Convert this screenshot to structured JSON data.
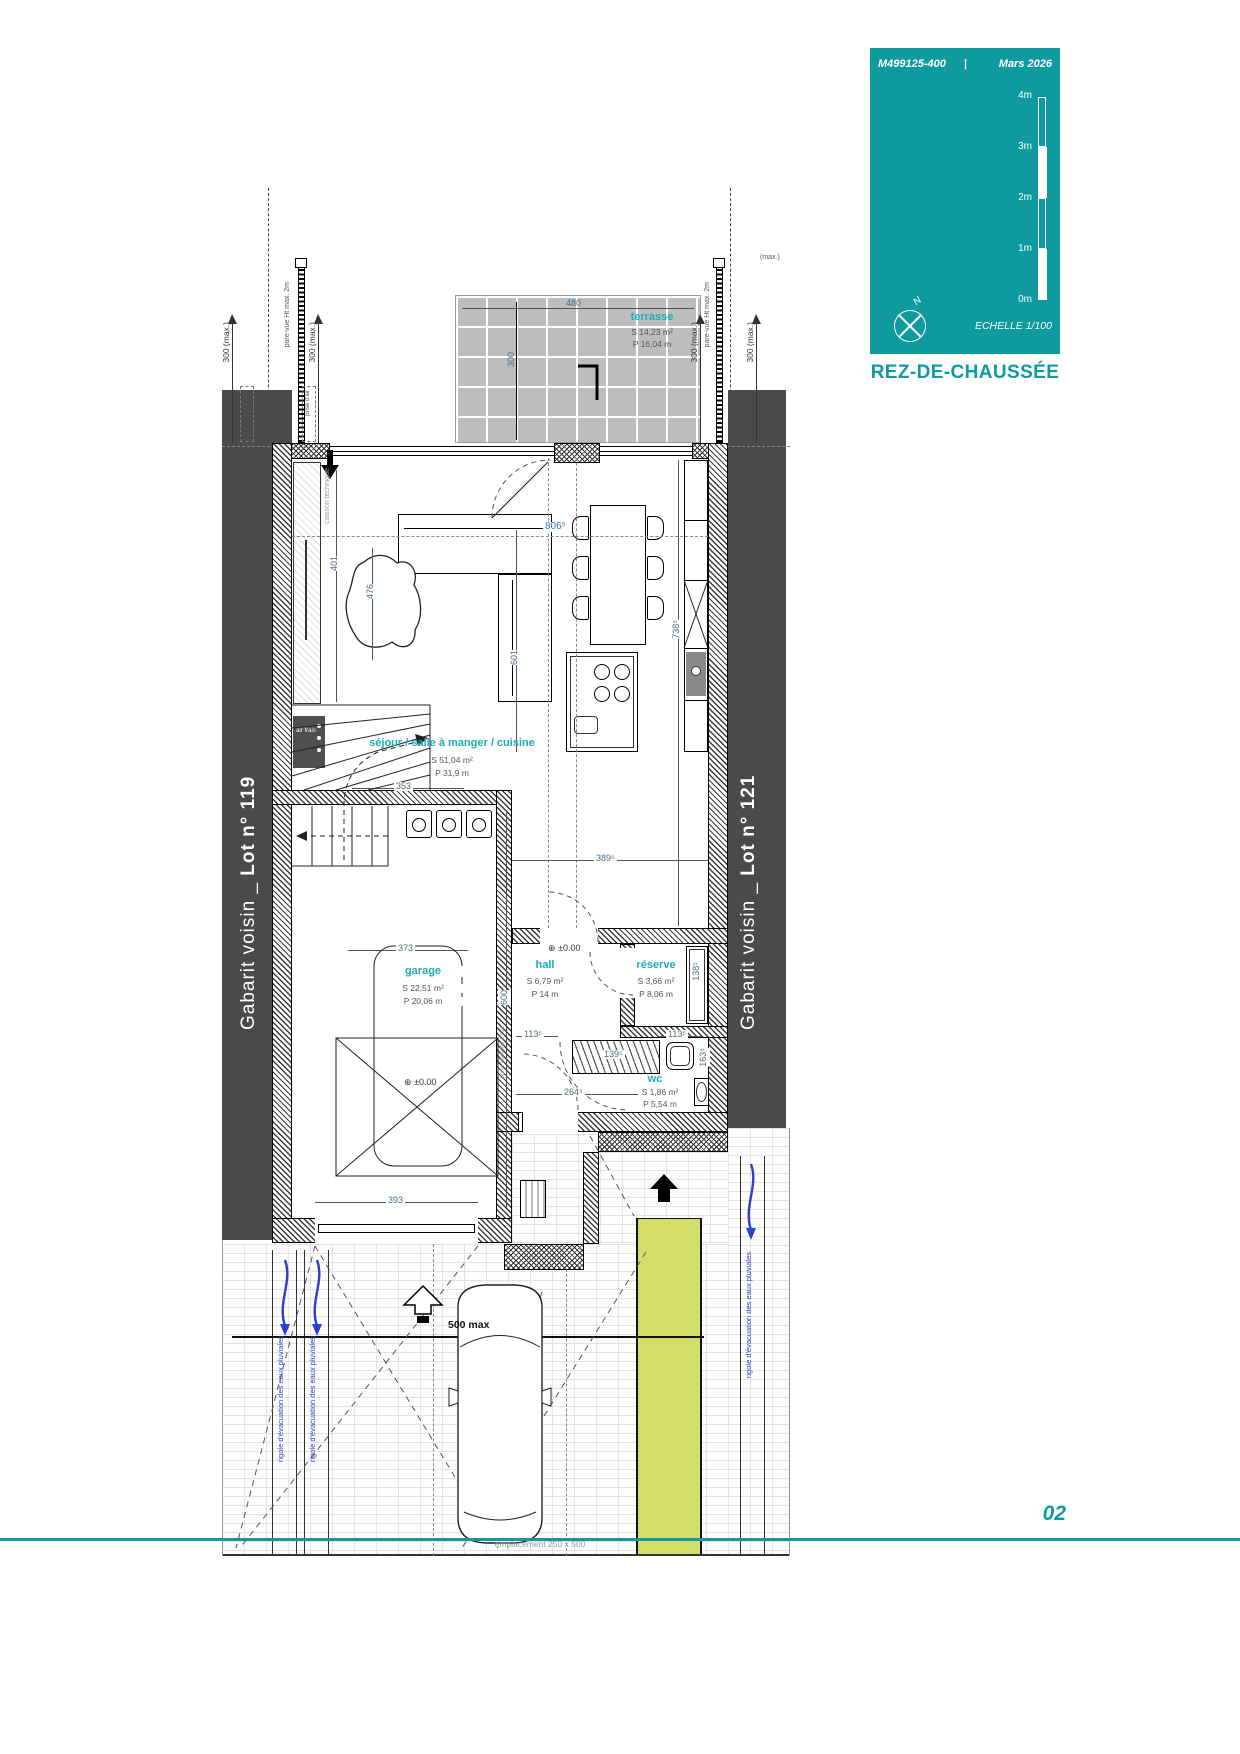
{
  "card": {
    "ref": "M499125-400",
    "divider": "|",
    "date": "Mars 2026",
    "scale_ticks": [
      "4m",
      "3m",
      "2m",
      "1m",
      "0m"
    ],
    "north_letter": "N",
    "echelle": "ECHELLE  1/100",
    "title": "REZ-DE-CHAUSSÉE",
    "accent_color": "#0f9aa0"
  },
  "footer": {
    "page": "02"
  },
  "neighbors": {
    "left": {
      "prefix": "Gabarit voisin _ ",
      "lot": "Lot n° 119"
    },
    "right": {
      "prefix": "Gabarit voisin _ ",
      "lot": "Lot n° 121"
    }
  },
  "rooms": {
    "terrasse": {
      "name": "terrasse",
      "area": "S  14,23 m²",
      "perim": "P  16,04 m"
    },
    "sejour": {
      "name": "séjour / salle à manger / cuisine",
      "area": "S  51,04 m²",
      "perim": "P  31,9 m"
    },
    "hall": {
      "name": "hall",
      "area": "S  6,79 m²",
      "perim": "P  14 m"
    },
    "reserve": {
      "name": "réserve",
      "area": "S  3,66 m²",
      "perim": "P  8,06 m"
    },
    "garage": {
      "name": "garage",
      "area": "S  22,51 m²",
      "perim": "P  20,06 m"
    },
    "wc": {
      "name": "wc",
      "area": "S  1,86 m²",
      "perim": "P  5,54 m"
    }
  },
  "dims": {
    "w480": "480",
    "terr300": "300",
    "w8065": "806⁵",
    "v401": "401",
    "v476": "476",
    "v601": "601",
    "v7385": "738⁵",
    "w353": "353",
    "w373": "373",
    "w3895": "389⁵",
    "v1385": "138⁵",
    "w1135l": "113⁵",
    "w1135r": "113⁵",
    "w1395": "139⁵",
    "v1635": "163⁵",
    "w2645": "264⁵",
    "v600": "600",
    "w393": "393",
    "w500": "500 max",
    "level": "±0.00",
    "level_icon": "⊕",
    "max300": "300 (max.)",
    "max_frag": "(max.)"
  },
  "site": {
    "pare_vue": "pare-vue Ht max. 2m",
    "prise_air": "prise d'air",
    "rigole": "rigole d'évacuation des eaux pluviales",
    "emplacement": "emplacement 250 x 500",
    "caisson": "caisson technique",
    "air_frais": "air frais",
    "porte_etanche": "porte étanche à l'air"
  },
  "colors": {
    "green_path": "#d4df69",
    "band": "#4a4a4a",
    "rigole_blue": "#2b3fd0"
  }
}
